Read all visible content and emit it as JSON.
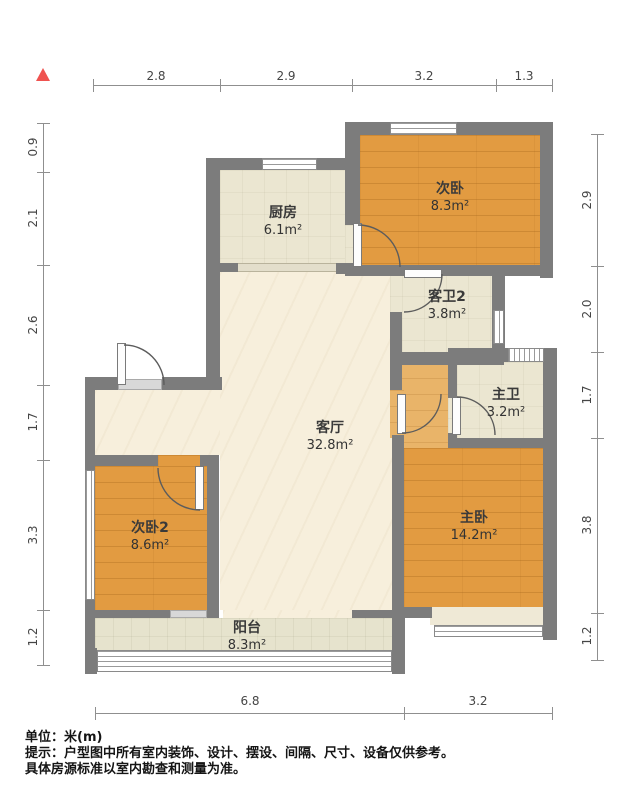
{
  "rooms": {
    "kitchen": {
      "name": "厨房",
      "area": "6.1m²"
    },
    "bedroom2": {
      "name": "次卧",
      "area": "8.3m²"
    },
    "bath2": {
      "name": "客卫2",
      "area": "3.8m²"
    },
    "master_bath": {
      "name": "主卫",
      "area": "3.2m²"
    },
    "living": {
      "name": "客厅",
      "area": "32.8m²"
    },
    "bedroom3": {
      "name": "次卧2",
      "area": "8.6m²"
    },
    "master_bedroom": {
      "name": "主卧",
      "area": "14.2m²"
    },
    "balcony": {
      "name": "阳台",
      "area": "8.3m²"
    }
  },
  "dims": {
    "top": [
      "2.8",
      "2.9",
      "3.2",
      "1.3"
    ],
    "bottom": [
      "6.8",
      "3.2"
    ],
    "left": [
      "0.9",
      "2.1",
      "2.6",
      "1.7",
      "3.3",
      "1.2"
    ],
    "right": [
      "2.9",
      "2.0",
      "1.7",
      "3.8",
      "1.2"
    ]
  },
  "footer": {
    "unit": "单位：米(m)",
    "tip": "提示：户型图中所有室内装饰、设计、摆设、间隔、尺寸、设备仅供参考。",
    "note": "具体房源标准以室内勘查和测量为准。"
  },
  "colors": {
    "wall": "#7c7c7c",
    "wood_floor": "#e29b41",
    "light_floor": "#f7efdc",
    "tile_floor": "#ebe6d1",
    "balcony_floor": "#e6e3cd",
    "north_marker": "#ef5350"
  }
}
